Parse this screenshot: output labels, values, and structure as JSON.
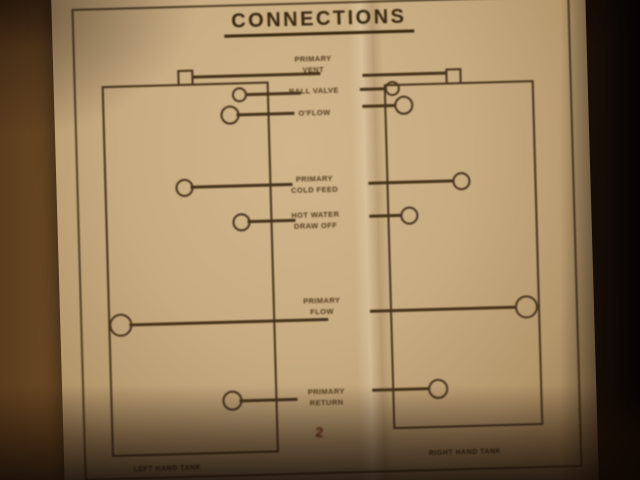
{
  "label": {
    "title": "CONNECTIONS",
    "connections": {
      "vent": {
        "l1": "PRIMARY",
        "l2": "VENT"
      },
      "ball_valve": {
        "l1": "BALL VALVE",
        "l2": "O'FLOW"
      },
      "cold_feed": {
        "l1": "PRIMARY",
        "l2": "COLD FEED"
      },
      "draw_off": {
        "l1": "HOT WATER",
        "l2": "DRAW OFF"
      },
      "flow": {
        "l1": "PRIMARY",
        "l2": "FLOW"
      },
      "return": {
        "l1": "PRIMARY",
        "l2": "RETURN"
      }
    },
    "tank_left": "LEFT HAND TANK",
    "tank_right": "RIGHT HAND TANK",
    "handwritten_mark": "2",
    "colors": {
      "ink": "#46311a",
      "paper": "#c7ab80",
      "wall": "#6e4c26",
      "mark": "#5c1d10"
    }
  }
}
